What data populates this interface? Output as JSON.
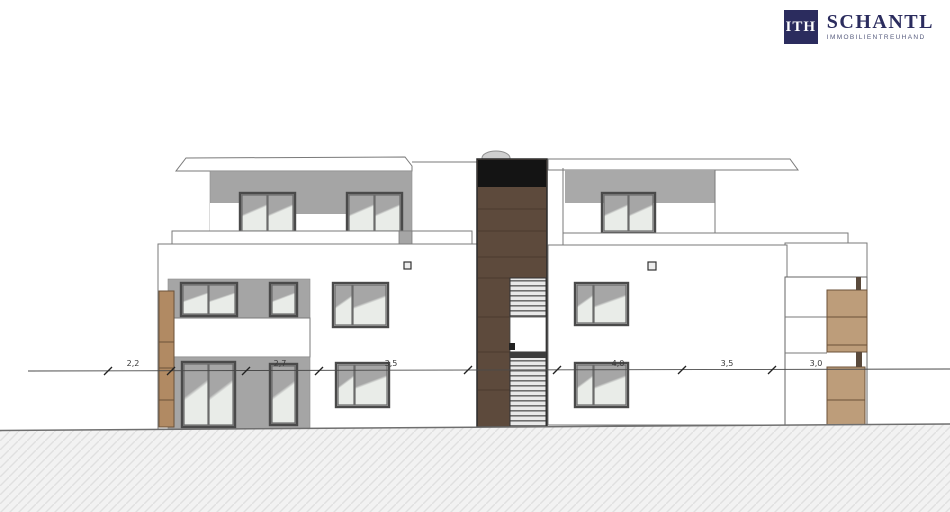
{
  "logo": {
    "monogram": "ITH",
    "name": "SCHANTL",
    "subtitle": "IMMOBILIENTREUHAND",
    "brand_color": "#2b2c5e"
  },
  "elevation": {
    "dimension_labels": [
      {
        "value": "2,2"
      },
      {
        "value": "2,7"
      },
      {
        "value": "3,5"
      },
      {
        "value": "4,0"
      },
      {
        "value": "3,5"
      },
      {
        "value": "3,0"
      }
    ],
    "colors": {
      "wall_gray": "#a5a5a5",
      "stair_tower_brown": "#5d4a3c",
      "tower_top_black": "#141414",
      "louver_tan": "#bd9d7a",
      "entrance_pillar_tan": "#b18a63",
      "glass_light": "#e9ece8"
    }
  }
}
